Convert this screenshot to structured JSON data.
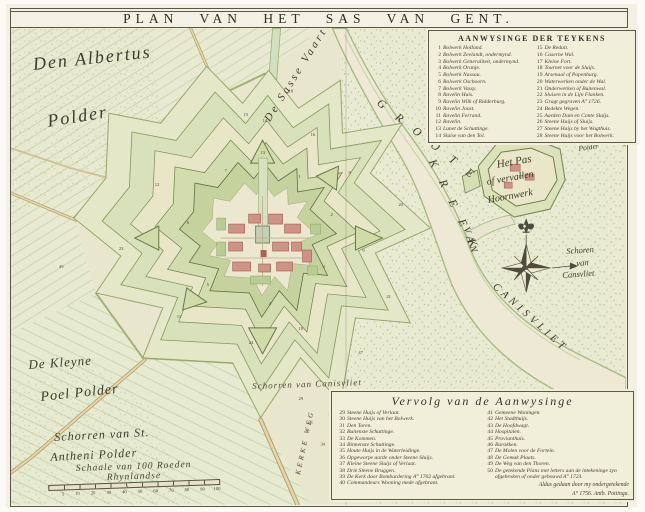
{
  "title": "PLAN VAN HET SAS VAN GENT.",
  "legend_top": {
    "title": "AANWYSINGE DER TEYKENS",
    "col1": [
      {
        "n": "1",
        "t": "Bolwerk Holland."
      },
      {
        "n": "2",
        "t": "Bolwerk Zeelandt, ondermynd."
      },
      {
        "n": "3",
        "t": "Bolwerk Generaliteit, ondermynd."
      },
      {
        "n": "4",
        "t": "Bolwerk Oranje."
      },
      {
        "n": "5",
        "t": "Bolwerk Nassau."
      },
      {
        "n": "6",
        "t": "Bolwerk Oschoorn."
      },
      {
        "n": "7",
        "t": "Bolwerk Vassy."
      },
      {
        "n": "8",
        "t": "Ravelin Huis."
      },
      {
        "n": "9",
        "t": "Ravelin Wilk of Ridderburg."
      },
      {
        "n": "10",
        "t": "Ravelin Joost."
      },
      {
        "n": "11",
        "t": "Ravelin Ferrand."
      },
      {
        "n": "12",
        "t": "Ravelin."
      },
      {
        "n": "13",
        "t": "Lunet de Schuttinge."
      },
      {
        "n": "14",
        "t": "Sluise van den Tol."
      }
    ],
    "col2": [
      {
        "n": "15",
        "t": "De Reduit."
      },
      {
        "n": "16",
        "t": "Caserne Wal."
      },
      {
        "n": "17",
        "t": "Kleine Fort."
      },
      {
        "n": "18",
        "t": "Tournet voor de Sluijs."
      },
      {
        "n": "19",
        "t": "Arsenaal of Papenburg."
      },
      {
        "n": "20",
        "t": "Waterwerken onder de Wal."
      },
      {
        "n": "21",
        "t": "Onderwerken of Buitenwal."
      },
      {
        "n": "22",
        "t": "Sluisen in de Lijn Flanken."
      },
      {
        "n": "23",
        "t": "Gragt gegraven A° 1726."
      },
      {
        "n": "24",
        "t": "Bedekte Wegen."
      },
      {
        "n": "25",
        "t": "Aarden Dam en Conte Sluijs."
      },
      {
        "n": "26",
        "t": "Steene Huijs of Sluijs."
      },
      {
        "n": "27",
        "t": "Steene Huijs by het Wagthuis."
      },
      {
        "n": "28",
        "t": "Steene Huijs voor het Bolwerk."
      }
    ]
  },
  "legend_bottom": {
    "title": "Vervolg van de Aanwysinge",
    "col1": [
      {
        "n": "29",
        "t": "Steene Huijs of Verlaat."
      },
      {
        "n": "30",
        "t": "Steene Huijs van het Bolwerk."
      },
      {
        "n": "31",
        "t": "Den Toren."
      },
      {
        "n": "32",
        "t": "Buitenste Schuttinge."
      },
      {
        "n": "33",
        "t": "De Kommen."
      },
      {
        "n": "34",
        "t": "Binnenste Schuttinge."
      },
      {
        "n": "35",
        "t": "Houte Huijs in de Waterleidinge."
      },
      {
        "n": "36",
        "t": "Opgeworpe aarde onder Steene Sluijs."
      },
      {
        "n": "37",
        "t": "Kleine Steene Sluijs of Verlaat."
      },
      {
        "n": "38",
        "t": "Drie Steene Bruggen."
      },
      {
        "n": "39",
        "t": "De Kerk door Bombardering A° 1702 afgebrant."
      },
      {
        "n": "40",
        "t": "Commandeurs Wooning mede afgebrant."
      }
    ],
    "col2": [
      {
        "n": "41",
        "t": "Gemeene Woningen."
      },
      {
        "n": "42",
        "t": "Het Stadthuijs."
      },
      {
        "n": "43",
        "t": "De Hoofdwagt."
      },
      {
        "n": "44",
        "t": "Hospitalen."
      },
      {
        "n": "45",
        "t": "Provianthuis."
      },
      {
        "n": "46",
        "t": "Barakken."
      },
      {
        "n": "47",
        "t": "De Molen voor de Fortein."
      },
      {
        "n": "48",
        "t": "De Gemak Plaats."
      },
      {
        "n": "49",
        "t": "De Weg van den Thoren."
      },
      {
        "n": "50",
        "t": "De getekende Plans met letters aan de intekeninge zyn afgebroken of onder gebouwd A° 1723."
      }
    ],
    "note1": "Aldus gedaan door my ondergetekende",
    "note2": "A° 1756. Anth. Pottinga."
  },
  "map": {
    "labels": {
      "albertus1": "Den Albertus",
      "albertus2": "Polder",
      "kleyne1": "De Kleyne",
      "kleyne2": "Poel Polder",
      "sasse_vaart": "De Sasse Vaart",
      "groote": "G R O O T E",
      "kreek": "K R E E K",
      "van": "VAN",
      "canisvliet": "CANISVLIET",
      "hetpas1": "Het Pas",
      "hetpas2": "of vervallen",
      "hetpas3": "Hoornwerk",
      "axelsche1": "Axelsche",
      "axelsche2": "Polder",
      "schoren1": "Schoren",
      "schoren2": "van",
      "schoren3": "Cansvliet",
      "schorren_canis": "Schorren van Canisvliet",
      "anthoni1": "Schorren van St.",
      "anthoni2": "Antheni Polder",
      "kerkeweg": "KERKE WEG"
    },
    "markers": [
      [
        288,
        150,
        "1"
      ],
      [
        320,
        188,
        "2"
      ],
      [
        312,
        240,
        "3"
      ],
      [
        258,
        277,
        "4"
      ],
      [
        196,
        258,
        "5"
      ],
      [
        176,
        196,
        "6"
      ],
      [
        214,
        144,
        "7"
      ],
      [
        338,
        146,
        "8"
      ],
      [
        352,
        224,
        "9"
      ],
      [
        288,
        302,
        "10"
      ],
      [
        166,
        290,
        "11"
      ],
      [
        144,
        158,
        "12"
      ],
      [
        250,
        126,
        "13"
      ],
      [
        252,
        94,
        "14"
      ],
      [
        233,
        88,
        "15"
      ],
      [
        300,
        108,
        "16"
      ],
      [
        508,
        150,
        "17"
      ],
      [
        278,
        64,
        "18"
      ],
      [
        388,
        178,
        "20"
      ],
      [
        376,
        270,
        "21"
      ],
      [
        108,
        222,
        "23"
      ],
      [
        238,
        316,
        "24"
      ],
      [
        288,
        372,
        "29"
      ],
      [
        298,
        396,
        "31"
      ],
      [
        310,
        418,
        "34"
      ],
      [
        318,
        388,
        "35"
      ],
      [
        348,
        326,
        "47"
      ],
      [
        48,
        240,
        "49"
      ]
    ]
  },
  "scale": {
    "caption": "Schaale van 100 Roeden Rhynlandse",
    "ticks": [
      "5",
      "10",
      "20",
      "30",
      "40",
      "50",
      "60",
      "70",
      "80",
      "90",
      "100"
    ]
  },
  "colors": {
    "paper": "#f3f1e4",
    "map_base": "#e9e6ce",
    "polder_green": "#e7ead0",
    "rampart_green": "#c6d29e",
    "outline_olive": "#5c6c3f",
    "building_red": "#cf9286",
    "ink": "#3e3a2c"
  }
}
